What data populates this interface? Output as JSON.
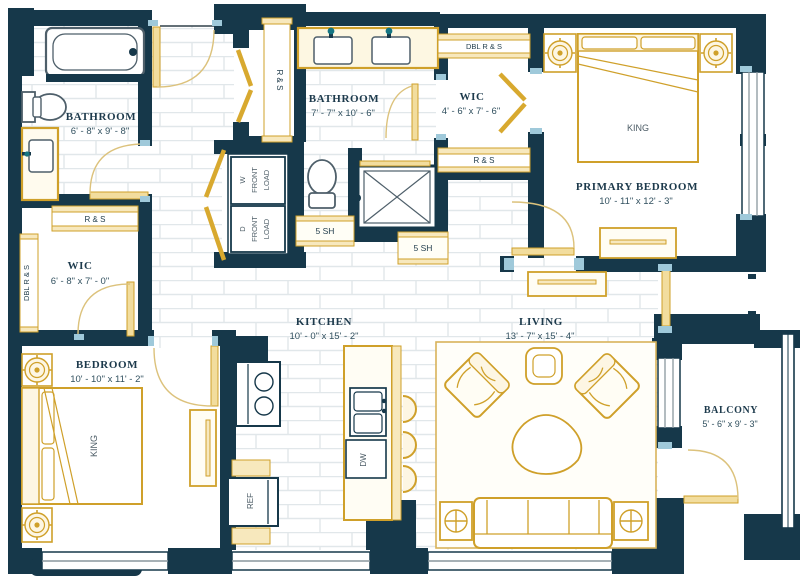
{
  "plan": {
    "rooms": {
      "bathroom_main": {
        "name": "BATHROOM",
        "dims": "6' - 8\" x 9' - 8\""
      },
      "wic_main": {
        "name": "WIC",
        "dims": "6' - 8\" x 7' - 0\""
      },
      "bedroom": {
        "name": "BEDROOM",
        "dims": "10' - 10\" x 11' - 2\""
      },
      "bathroom_primary": {
        "name": "BATHROOM",
        "dims": "7' - 7\" x 10' - 6\""
      },
      "wic_primary": {
        "name": "WIC",
        "dims": "4' - 6\" x 7' - 6\""
      },
      "primary_bedroom": {
        "name": "PRIMARY BEDROOM",
        "dims": "10' - 11\" x 12' - 3\""
      },
      "kitchen": {
        "name": "KITCHEN",
        "dims": "10' - 0\" x 15' - 2\""
      },
      "living": {
        "name": "LIVING",
        "dims": "13' - 7\" x 15' - 4\""
      },
      "balcony": {
        "name": "BALCONY",
        "dims": "5' - 6\" x 9' - 3\""
      }
    },
    "labels": {
      "king": "KING",
      "ref": "REF",
      "dw": "DW",
      "rs": "R & S",
      "dbl_rs": "DBL R & S",
      "sh5": "5 SH",
      "washer": [
        "W",
        "FRONT",
        "LOAD"
      ],
      "dryer": [
        "D",
        "FRONT",
        "LOAD"
      ]
    },
    "colors": {
      "wall": "#16384a",
      "furniture_gold": "#cfa02a",
      "shelf_fill": "#f7e8bd",
      "jamb_accent": "#9fc9da"
    }
  }
}
